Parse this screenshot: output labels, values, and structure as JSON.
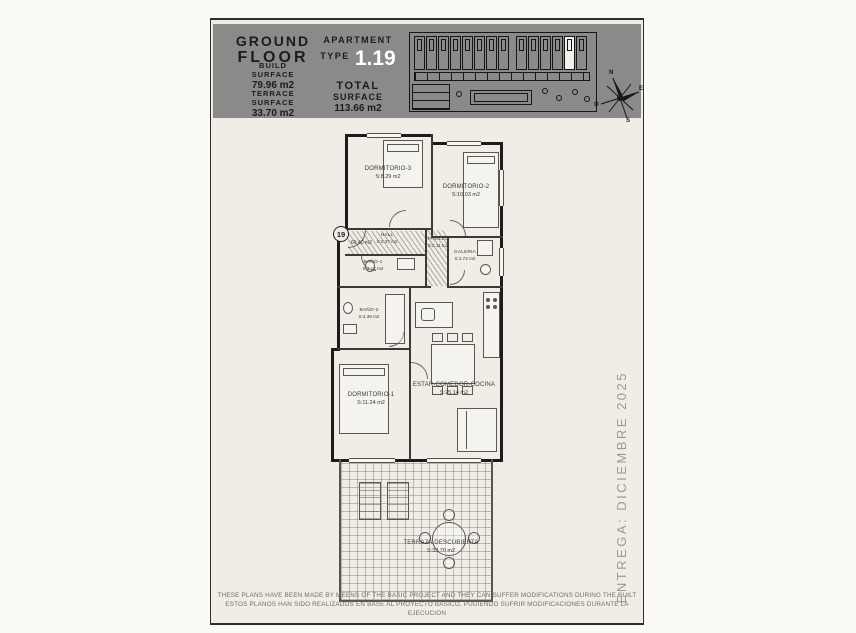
{
  "header": {
    "floor_line1": "GROUND",
    "floor_line2": "FLOOR",
    "apartment_label": "APARTMENT",
    "apartment_type_label": "TYPE",
    "apartment_number": "1.19",
    "build_surface_label1": "BUILD",
    "build_surface_label2": "SURFACE",
    "build_surface_value": "79.96 m2",
    "terrace_surface_label1": "TERRACE",
    "terrace_surface_label2": "SURFACE",
    "terrace_surface_value": "33.70 m2",
    "total_surface_label1": "TOTAL",
    "total_surface_label2": "SURFACE",
    "total_surface_value": "113.66 m2"
  },
  "site_plan": {
    "compass": {
      "n": "N",
      "e": "E",
      "s": "S",
      "w": "O"
    }
  },
  "unit_marker": "19",
  "annotations": {
    "entry_level": "69.40 m2"
  },
  "rooms": [
    {
      "name": "DORMITORIO-3",
      "area": "S:8.29 m2"
    },
    {
      "name": "DORMITORIO-2",
      "area": "S:10.03 m2"
    },
    {
      "name": "HALL",
      "area": "S:2.37 m2"
    },
    {
      "name": "PASILLO",
      "area": "S:2.11 m2"
    },
    {
      "name": "BAÑO-1",
      "area": "S:4.12 m2"
    },
    {
      "name": "BAÑO-2",
      "area": "S:4.38 m2"
    },
    {
      "name": "GALERIA",
      "area": "S:1.72 m2"
    },
    {
      "name": "DORMITORIO-1",
      "area": "S:11.24 m2"
    },
    {
      "name": "ESTAR-COMEDOR-COCINA",
      "area": "S:25.14 m2"
    },
    {
      "name": "TERRAZA DESCUBIERTA",
      "area": "S:33.70 m2"
    }
  ],
  "delivery_note": "ENTREGA: DICIEMBRE 2025",
  "disclaimer_en": "THESE PLANS HAVE BEEN MADE BY MEENS OF THE BASIC PROJECT AND THEY CAN SUFFER MODIFICATIONS DURING THE BUILT",
  "disclaimer_es": "ESTOS PLANOS HAN SIDO REALIZADOS EN BASE AL PROYECTO BASICO, PUDIENDO SUFRIR MODIFICACIONES DURANTE LA EJECUCION",
  "colors": {
    "header_band": "#8a8a8a",
    "sheet_background": "#efede6",
    "highlight_unit": "#f2f1ec",
    "accent_text": "#ffffff"
  }
}
